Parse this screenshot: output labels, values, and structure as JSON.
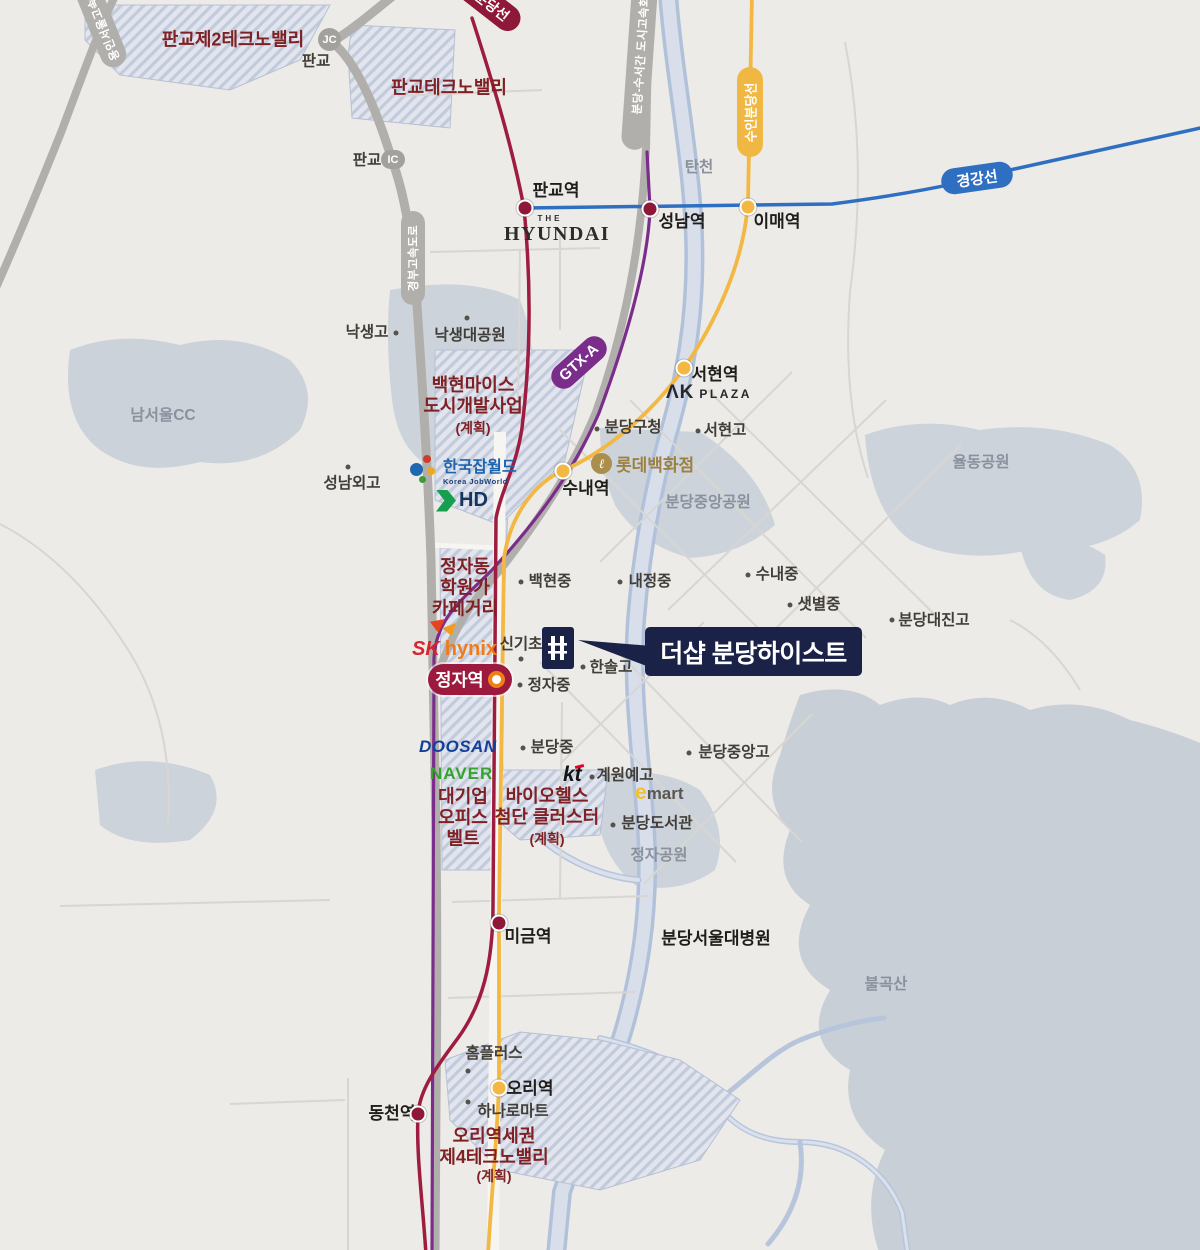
{
  "meta": {
    "title": "더샵 분당하이스트 입지 안내도"
  },
  "colors": {
    "bg": "#edebe7",
    "park": "#ccd3db",
    "mountain": "#c8cfd7",
    "stream": "#b2c1da",
    "stream_light": "#d8dfeb",
    "road_major": "#b1afac",
    "road_minor": "#d8d6d2",
    "line_red": "#9e1c3f",
    "line_yellow": "#f2b843",
    "line_purple": "#7b2d8c",
    "line_blue": "#2f6fc1",
    "navy": "#1a2248",
    "maroon": "#7e2024"
  },
  "callout": {
    "title": "더샵 분당하이스트"
  },
  "badges": {
    "sinbundang": "신분당선",
    "suinbundang": "수인분당선",
    "gyeonggang": "경강선",
    "gtxa": "GTX-A",
    "jeongja": "정자역",
    "gyeongbu": "경부고속도로",
    "bundangsuseo": "분당-수서간 도시고속화도로",
    "yongin": "용인서울고속도로",
    "ic": "IC",
    "jc": "JC"
  },
  "logos": {
    "hyundai_the": "THE",
    "hyundai": "HYUNDAI",
    "akplaza_ak": "ΛK",
    "akplaza_plaza": "PLAZA",
    "lotte_mark": "ℓ",
    "lotte": "롯데백화점",
    "jobworld": "한국잡월드",
    "jobworld_sub": "Korea JobWorld",
    "hd": "HD",
    "sk": "SK",
    "hynix": "hynix",
    "doosan": "DOOSAN",
    "naver": "NAVER",
    "kt": "kt",
    "emart_e": "e",
    "emart_mart": "mart"
  },
  "labels": [
    {
      "t": "판교역",
      "x": 556,
      "y": 191,
      "c": "station"
    },
    {
      "t": "성남역",
      "x": 682,
      "y": 222,
      "c": "station"
    },
    {
      "t": "이매역",
      "x": 777,
      "y": 222,
      "c": "station"
    },
    {
      "t": "서현역",
      "x": 715,
      "y": 375,
      "c": "station"
    },
    {
      "t": "수내역",
      "x": 586,
      "y": 489,
      "c": "station"
    },
    {
      "t": "미금역",
      "x": 528,
      "y": 937,
      "c": "station"
    },
    {
      "t": "오리역",
      "x": 530,
      "y": 1089,
      "c": "station"
    },
    {
      "t": "동천역",
      "x": 392,
      "y": 1114,
      "c": "station"
    },
    {
      "t": "분당서울대병원",
      "x": 716,
      "y": 939,
      "c": "station"
    },
    {
      "t": "판교",
      "x": 316,
      "y": 62,
      "c": "poi"
    },
    {
      "t": "판교",
      "x": 367,
      "y": 161,
      "c": "poi"
    },
    {
      "t": "낙생고",
      "x": 367,
      "y": 333,
      "c": "poi"
    },
    {
      "t": "낙생대공원",
      "x": 470,
      "y": 336,
      "c": "poi"
    },
    {
      "t": "성남외고",
      "x": 352,
      "y": 484,
      "c": "poi"
    },
    {
      "t": "분당구청",
      "x": 633,
      "y": 428,
      "c": "poi"
    },
    {
      "t": "서현고",
      "x": 725,
      "y": 431,
      "c": "poi"
    },
    {
      "t": "백현중",
      "x": 550,
      "y": 582,
      "c": "poi"
    },
    {
      "t": "내정중",
      "x": 650,
      "y": 582,
      "c": "poi"
    },
    {
      "t": "수내중",
      "x": 777,
      "y": 575,
      "c": "poi"
    },
    {
      "t": "샛별중",
      "x": 819,
      "y": 605,
      "c": "poi"
    },
    {
      "t": "분당대진고",
      "x": 934,
      "y": 621,
      "c": "poi"
    },
    {
      "t": "신기초",
      "x": 521,
      "y": 645,
      "c": "poi"
    },
    {
      "t": "한솔고",
      "x": 611,
      "y": 668,
      "c": "poi"
    },
    {
      "t": "정자중",
      "x": 549,
      "y": 686,
      "c": "poi"
    },
    {
      "t": "분당중",
      "x": 552,
      "y": 748,
      "c": "poi"
    },
    {
      "t": "분당중앙고",
      "x": 734,
      "y": 753,
      "c": "poi"
    },
    {
      "t": "계원예고",
      "x": 625,
      "y": 776,
      "c": "poi"
    },
    {
      "t": "분당도서관",
      "x": 657,
      "y": 824,
      "c": "poi"
    },
    {
      "t": "홈플러스",
      "x": 494,
      "y": 1054,
      "c": "poi"
    },
    {
      "t": "하나로마트",
      "x": 513,
      "y": 1112,
      "c": "poi"
    },
    {
      "t": "남서울CC",
      "x": 163,
      "y": 416,
      "c": "park"
    },
    {
      "t": "탄천",
      "x": 699,
      "y": 168,
      "c": "park"
    },
    {
      "t": "분당중앙공원",
      "x": 708,
      "y": 503,
      "c": "park"
    },
    {
      "t": "율동공원",
      "x": 981,
      "y": 463,
      "c": "park"
    },
    {
      "t": "정자공원",
      "x": 659,
      "y": 856,
      "c": "park"
    },
    {
      "t": "불곡산",
      "x": 886,
      "y": 985,
      "c": "park"
    },
    {
      "t": "판교제2테크노밸리",
      "x": 233,
      "y": 40,
      "c": "zone"
    },
    {
      "t": "판교테크노밸리",
      "x": 449,
      "y": 88,
      "c": "zone"
    },
    {
      "t": "백현마이스\n도시개발사업",
      "x": 473,
      "y": 396,
      "c": "zone"
    },
    {
      "t": "(계획)",
      "x": 473,
      "y": 428,
      "c": "zone-plan"
    },
    {
      "t": "정자동\n학원가\n카페거리",
      "x": 465,
      "y": 588,
      "c": "zone"
    },
    {
      "t": "대기업\n오피스\n벨트",
      "x": 463,
      "y": 818,
      "c": "zone"
    },
    {
      "t": "바이오헬스\n첨단 클러스터",
      "x": 547,
      "y": 807,
      "c": "zone"
    },
    {
      "t": "(계획)",
      "x": 547,
      "y": 839,
      "c": "zone-plan"
    },
    {
      "t": "오리역세권\n제4테크노밸리",
      "x": 494,
      "y": 1147,
      "c": "zone"
    },
    {
      "t": "(계획)",
      "x": 494,
      "y": 1176,
      "c": "zone-plan"
    }
  ],
  "dots": [
    [
      396,
      333
    ],
    [
      467,
      318
    ],
    [
      348,
      467
    ],
    [
      597,
      429
    ],
    [
      698,
      431
    ],
    [
      521,
      582
    ],
    [
      620,
      582
    ],
    [
      748,
      575
    ],
    [
      790,
      605
    ],
    [
      892,
      620
    ],
    [
      521,
      659
    ],
    [
      583,
      667
    ],
    [
      520,
      685
    ],
    [
      523,
      748
    ],
    [
      689,
      753
    ],
    [
      592,
      777
    ],
    [
      613,
      825
    ],
    [
      468,
      1071
    ],
    [
      468,
      1102
    ]
  ],
  "stations": [
    [
      525,
      208,
      "r"
    ],
    [
      650,
      209,
      "r"
    ],
    [
      748,
      207,
      "y"
    ],
    [
      684,
      368,
      "y"
    ],
    [
      563,
      471,
      "y"
    ],
    [
      499,
      923,
      "r"
    ],
    [
      499,
      1088,
      "y"
    ],
    [
      418,
      1114,
      "r"
    ]
  ]
}
